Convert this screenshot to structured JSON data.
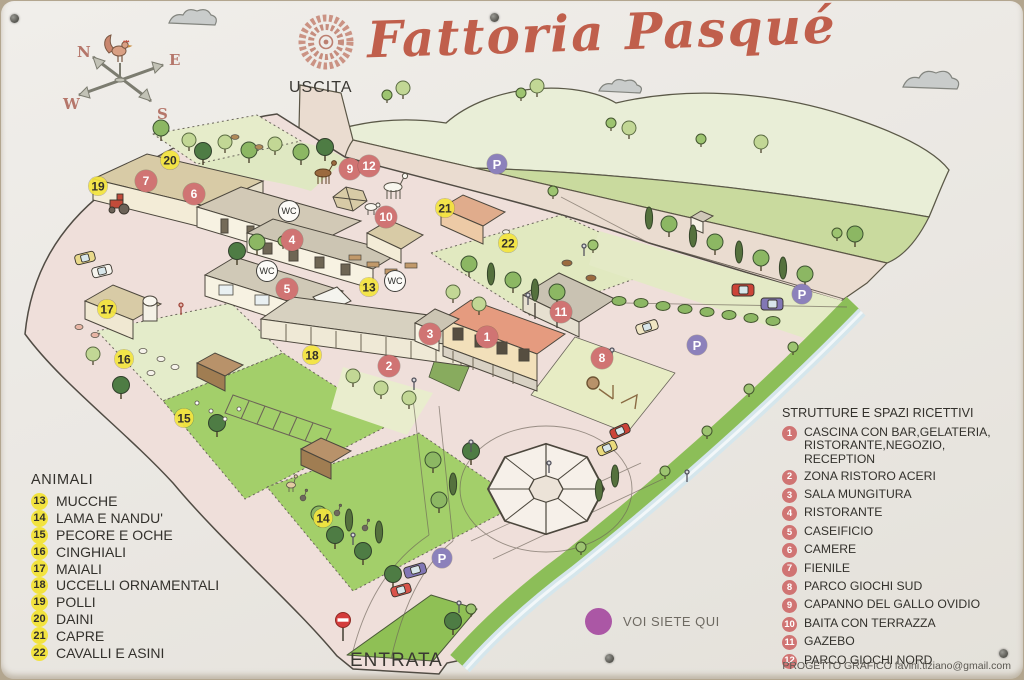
{
  "sign": {
    "title": "Fattoria Pasqué",
    "credit": "PROGETTO GRAFICO favini.tiziano@gmail.com"
  },
  "labels": {
    "uscita": "USCITA",
    "entrata": "ENTRATA",
    "you_are_here": "VOI SIETE QUI"
  },
  "compass": {
    "n": "N",
    "e": "E",
    "s": "S",
    "w": "W"
  },
  "legend_animals": {
    "title": "ANIMALI",
    "items": [
      {
        "num": "13",
        "label": "MUCCHE"
      },
      {
        "num": "14",
        "label": "LAMA E NANDU'"
      },
      {
        "num": "15",
        "label": "PECORE E OCHE"
      },
      {
        "num": "16",
        "label": "CINGHIALI"
      },
      {
        "num": "17",
        "label": "MAIALI"
      },
      {
        "num": "18",
        "label": "UCCELLI ORNAMENTALI"
      },
      {
        "num": "19",
        "label": "POLLI"
      },
      {
        "num": "20",
        "label": "DAINI"
      },
      {
        "num": "21",
        "label": "CAPRE"
      },
      {
        "num": "22",
        "label": "CAVALLI E ASINI"
      }
    ]
  },
  "legend_structures": {
    "title": "STRUTTURE E SPAZI RICETTIVI",
    "items": [
      {
        "num": "1",
        "label": "CASCINA CON BAR,GELATERIA, RISTORANTE,NEGOZIO, RECEPTION"
      },
      {
        "num": "2",
        "label": "ZONA RISTORO ACERI"
      },
      {
        "num": "3",
        "label": "SALA MUNGITURA"
      },
      {
        "num": "4",
        "label": "RISTORANTE"
      },
      {
        "num": "5",
        "label": "CASEIFICIO"
      },
      {
        "num": "6",
        "label": "CAMERE"
      },
      {
        "num": "7",
        "label": "FIENILE"
      },
      {
        "num": "8",
        "label": "PARCO GIOCHI SUD"
      },
      {
        "num": "9",
        "label": "CAPANNO DEL GALLO OVIDIO"
      },
      {
        "num": "10",
        "label": "BAITA CON TERRAZZA"
      },
      {
        "num": "11",
        "label": "GAZEBO"
      },
      {
        "num": "12",
        "label": "PARCO GIOCHI NORD"
      }
    ]
  },
  "map_markers": {
    "parking_label": "P",
    "wc_label": "WC",
    "structures": [
      {
        "num": "1",
        "x": 486,
        "y": 336
      },
      {
        "num": "2",
        "x": 388,
        "y": 365
      },
      {
        "num": "3",
        "x": 429,
        "y": 333
      },
      {
        "num": "4",
        "x": 291,
        "y": 239
      },
      {
        "num": "5",
        "x": 286,
        "y": 288
      },
      {
        "num": "6",
        "x": 193,
        "y": 193
      },
      {
        "num": "7",
        "x": 145,
        "y": 180
      },
      {
        "num": "8",
        "x": 601,
        "y": 357
      },
      {
        "num": "9",
        "x": 349,
        "y": 168
      },
      {
        "num": "10",
        "x": 385,
        "y": 216
      },
      {
        "num": "11",
        "x": 560,
        "y": 311
      },
      {
        "num": "12",
        "x": 368,
        "y": 165
      }
    ],
    "animals": [
      {
        "num": "13",
        "x": 368,
        "y": 286
      },
      {
        "num": "14",
        "x": 322,
        "y": 517
      },
      {
        "num": "15",
        "x": 183,
        "y": 417
      },
      {
        "num": "16",
        "x": 123,
        "y": 358
      },
      {
        "num": "17",
        "x": 106,
        "y": 308
      },
      {
        "num": "18",
        "x": 311,
        "y": 354
      },
      {
        "num": "19",
        "x": 97,
        "y": 185
      },
      {
        "num": "20",
        "x": 169,
        "y": 159
      },
      {
        "num": "21",
        "x": 444,
        "y": 207
      },
      {
        "num": "22",
        "x": 507,
        "y": 242
      }
    ],
    "parking": [
      {
        "x": 496,
        "y": 163
      },
      {
        "x": 696,
        "y": 344
      },
      {
        "x": 801,
        "y": 293
      },
      {
        "x": 441,
        "y": 557
      }
    ],
    "wc": [
      {
        "x": 288,
        "y": 210
      },
      {
        "x": 266,
        "y": 270
      },
      {
        "x": 394,
        "y": 280
      }
    ]
  },
  "colors": {
    "title": "#c05f4c",
    "structure_badge": "#d07473",
    "animal_badge": "#f2e340",
    "parking_badge": "#8c81bb",
    "you_are_here_dot": "#ab57a5",
    "field_green": "#a3cf6a",
    "ground_pink": "#efdfda"
  }
}
